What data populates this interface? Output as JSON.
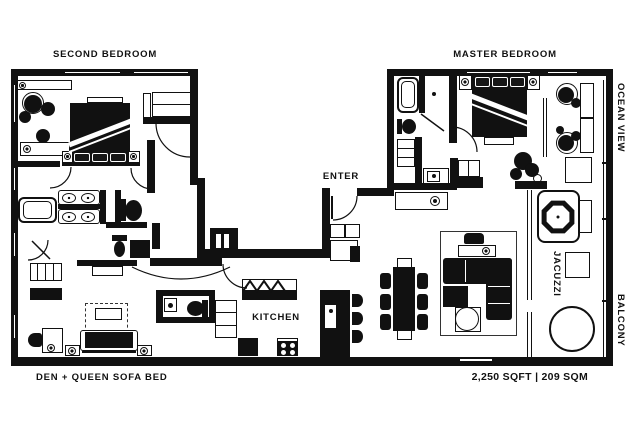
{
  "floorplan": {
    "rooms": {
      "second_bedroom": "SECOND BEDROOM",
      "master_bedroom": "MASTER BEDROOM",
      "kitchen": "KITCHEN",
      "den": "DEN + QUEEN SOFA BED"
    },
    "annotations": {
      "enter": "ENTER",
      "ocean_view": "OCEAN VIEW",
      "jacuzzi": "JACUZZI",
      "balcony": "BALCONY",
      "area": "2,250 SQFT | 209 SQM"
    },
    "colors": {
      "ink": "#111111",
      "paper": "#ffffff"
    }
  }
}
